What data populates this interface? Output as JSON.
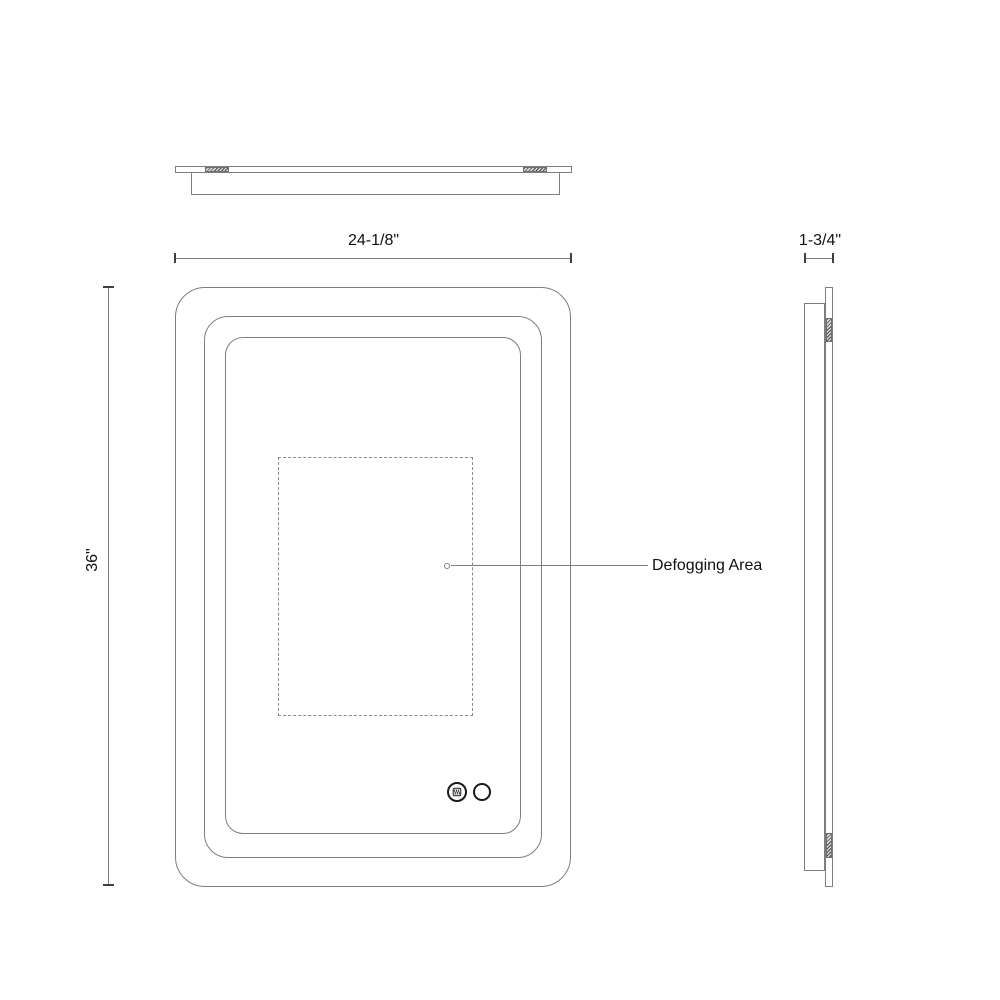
{
  "colors": {
    "line": "#7e7e7e",
    "dash": "#8a8a8a",
    "dark": "#1a1a1a",
    "tick": "#3f3f3f",
    "text": "#111111"
  },
  "dimensions": {
    "width": "24-1/8\"",
    "depth": "1-3/4\"",
    "height": "36\""
  },
  "annotations": {
    "defogging": "Defogging Area"
  },
  "icons": {
    "defogger": "defogger-icon",
    "power": "power-button-icon"
  }
}
